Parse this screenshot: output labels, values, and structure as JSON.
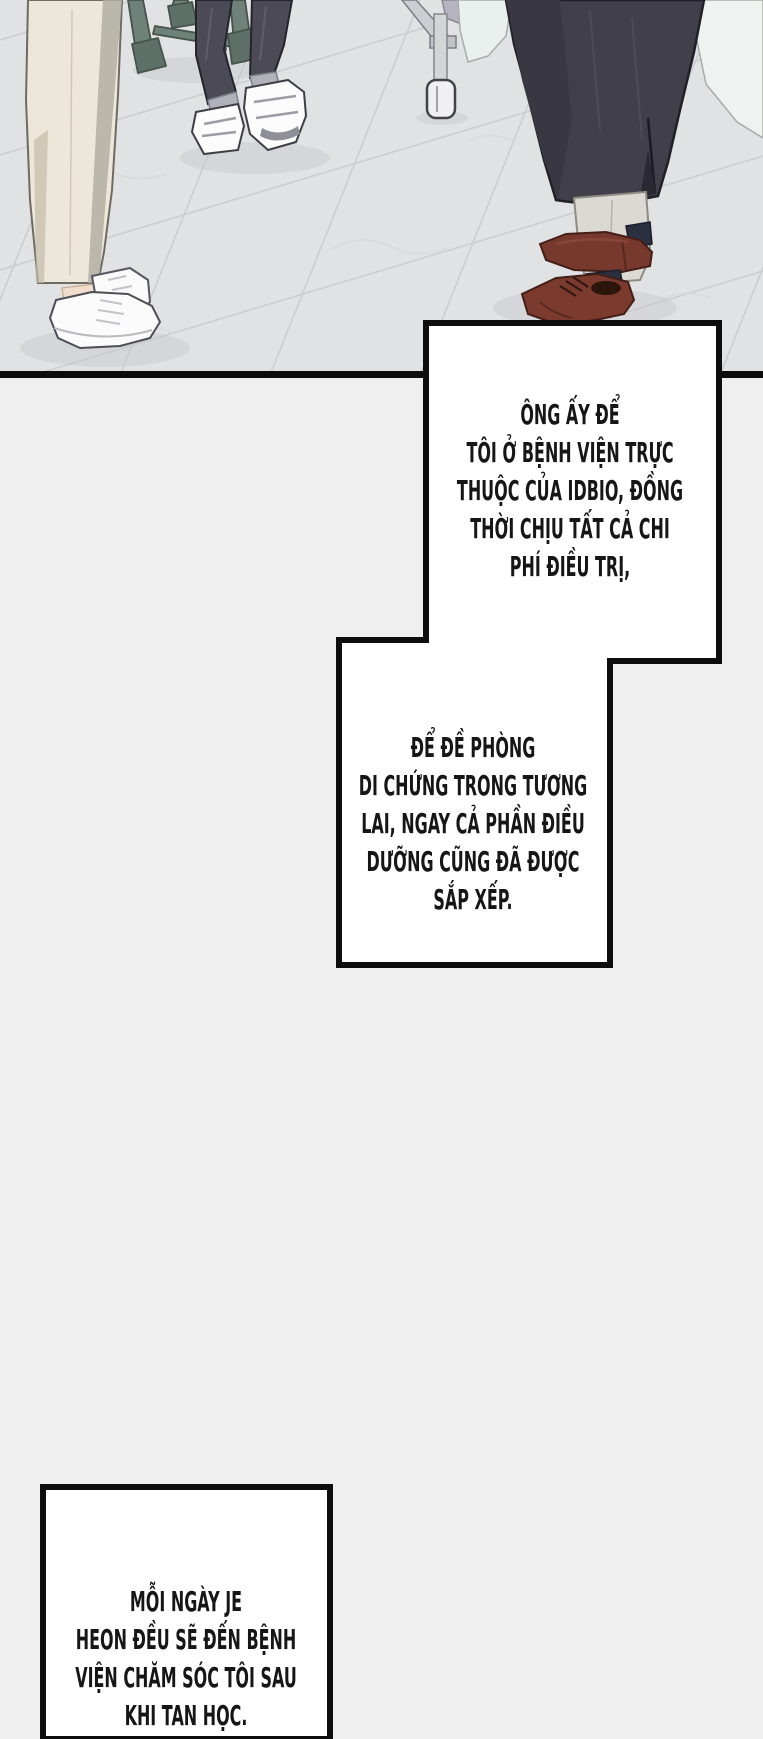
{
  "page": {
    "width": 763,
    "height": 1739,
    "background_color": "#efeff0"
  },
  "panel": {
    "name": "hospital-room-floor-scene",
    "border_color": "#0d0d0d",
    "floor_color": "#e1e2e4",
    "tile_line_color": "#c9cacd",
    "colors": {
      "stool_legs": "#6f8279",
      "cream_trousers": "#ece7d8",
      "charcoal_trousers": "#4b4a55",
      "white_sneakers": "#fbfbfc",
      "long_coat": "#413f4a",
      "beige_slacks": "#dcd9d4",
      "brown_shoes": "#77392e",
      "bed_metal": "#cdced4",
      "mint_blanket": "#eaf0ed"
    },
    "elements": [
      "stool-green-legs",
      "cream-trousers-legs",
      "white-chunky-sneakers",
      "charcoal-trousers-legs",
      "white-velcro-sneakers",
      "hospital-bed-frame",
      "bed-caster-wheel",
      "mint-blanket",
      "long-dark-coat",
      "beige-slacks",
      "brown-leather-shoes"
    ]
  },
  "speech_boxes": {
    "fill": "#ffffff",
    "border_color": "#0d0d0d",
    "text_color": "#161616",
    "box1": {
      "lines": [
        "ÔNG ẤY ĐỂ",
        "TÔI Ở BỆNH VIỆN TRỰC",
        "THUỘC CỦA IDBIO, ĐỒNG",
        "THỜI CHỊU TẤT CẢ CHI",
        "PHÍ ĐIỀU TRỊ,"
      ]
    },
    "box2": {
      "lines": [
        "ĐỂ ĐỀ PHÒNG",
        "DI CHỨNG TRONG TƯƠNG",
        "LAI, NGAY CẢ PHẦN ĐIỀU",
        "DƯỠNG CŨNG ĐÃ ĐƯỢC",
        "SẮP XẾP."
      ]
    },
    "box3": {
      "lines": [
        "MỖI NGÀY JE",
        "HEON ĐỀU SẼ ĐẾN BỆNH",
        "VIỆN CHĂM SÓC TÔI SAU",
        "KHI TAN HỌC."
      ]
    }
  }
}
